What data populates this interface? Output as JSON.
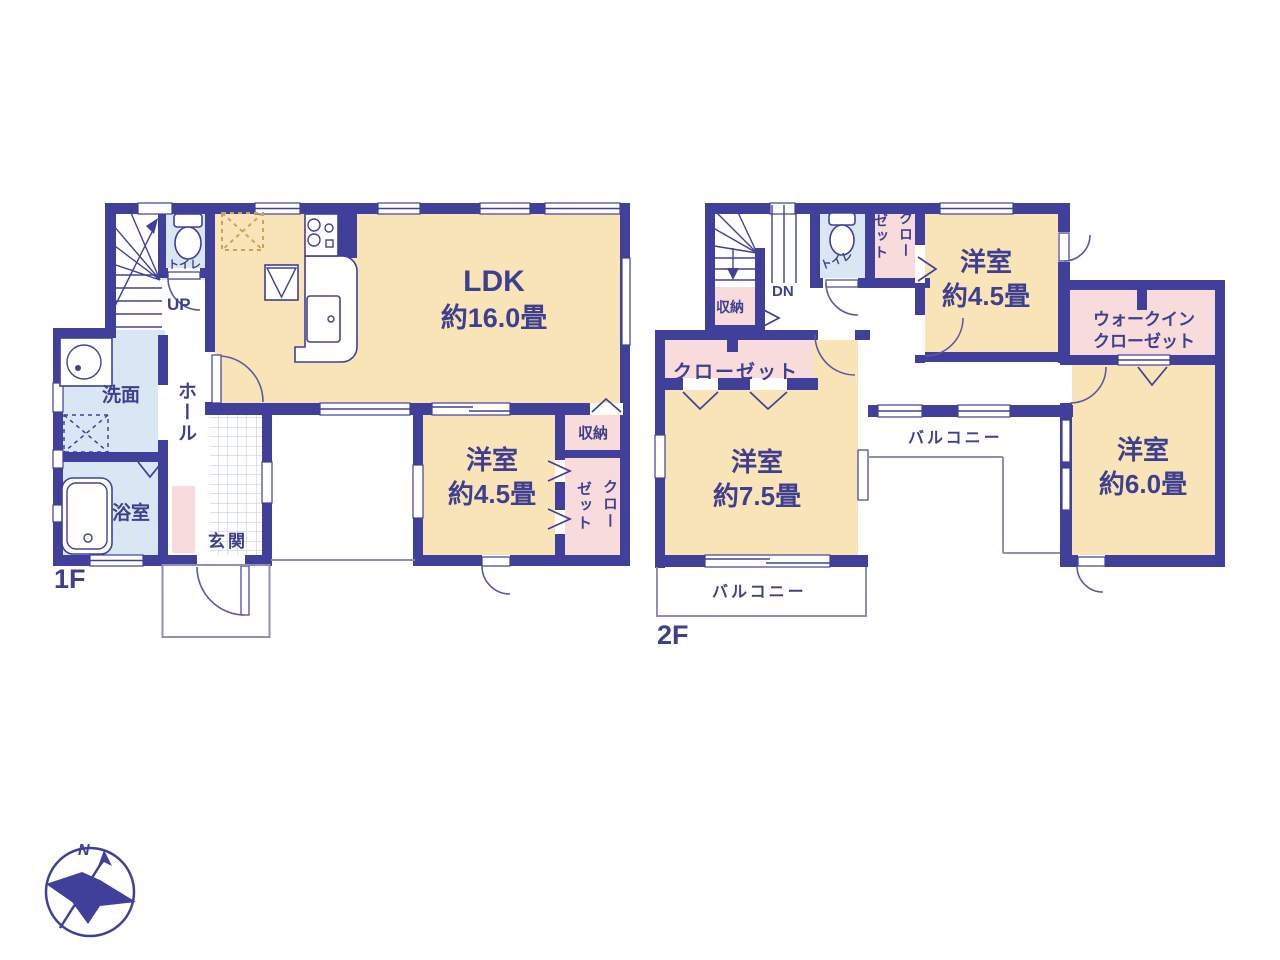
{
  "plan": {
    "floor1": {
      "floor_label": "1F",
      "ldk": {
        "name": "LDK",
        "size": "約16.0畳"
      },
      "bedroom": {
        "name": "洋室",
        "size": "約4.5畳"
      },
      "washroom": "洗面",
      "bathroom": "浴室",
      "entrance": "玄関",
      "hall": "ホール",
      "toilet": "トイレ",
      "storage": "収納",
      "closet_col_right": "クロー",
      "closet_col_left": "ゼット",
      "stairs": "UP"
    },
    "floor2": {
      "floor_label": "2F",
      "bedroom_small": {
        "name": "洋室",
        "size": "約4.5畳"
      },
      "bedroom_mid": {
        "name": "洋室",
        "size": "約7.5畳"
      },
      "bedroom_large": {
        "name": "洋室",
        "size": "約6.0畳"
      },
      "wic_line1": "ウォークイン",
      "wic_line2": "クローゼット",
      "closet": "クローゼット",
      "closet_col_right": "クロー",
      "closet_col_left": "ゼット",
      "toilet": "トイレ",
      "storage": "収納",
      "balcony_side": "バルコニー",
      "balcony_bottom": "バルコニー",
      "stairs": "DN"
    },
    "compass_north": "N",
    "colors": {
      "wall": "#40409A",
      "room_cream": "#F9E4B8",
      "room_blue": "#D9E6F4",
      "room_pink": "#F8DCDC",
      "text": "#3F3F8F"
    }
  }
}
